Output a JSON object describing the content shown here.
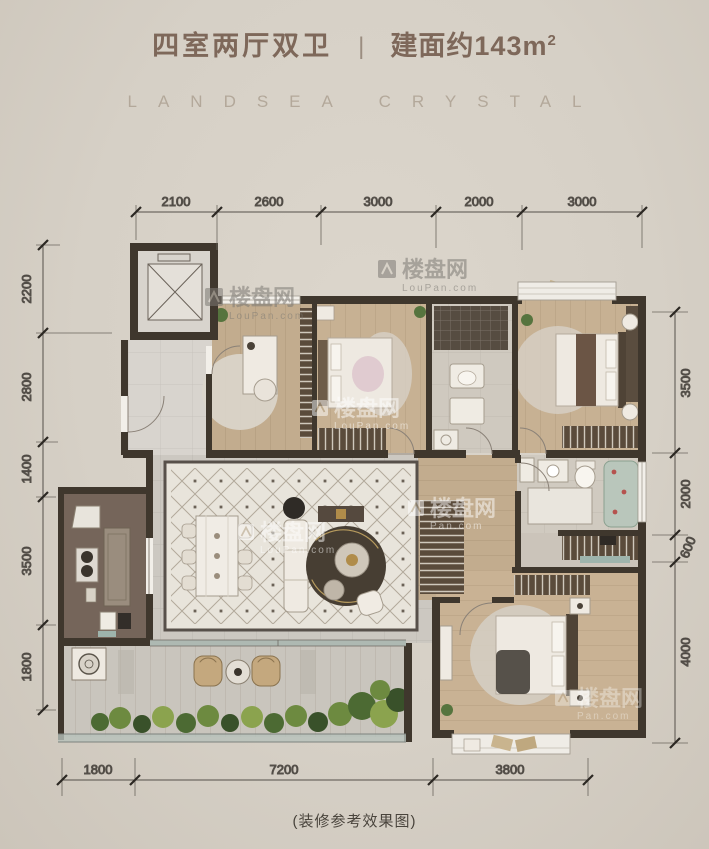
{
  "header": {
    "title": "四室两厅双卫",
    "separator": "|",
    "area_text": "建面约143m",
    "area_sup": "2",
    "brand": "LANDSEA CRYSTAL"
  },
  "dimensions": {
    "top": [
      "2100",
      "2600",
      "3000",
      "2000",
      "3000"
    ],
    "left": [
      "2200",
      "2800",
      "1400",
      "3500",
      "1800"
    ],
    "right": [
      "3500",
      "2000",
      "600",
      "4000"
    ],
    "bottom": [
      "1800",
      "7200",
      "3800"
    ]
  },
  "caption": "(装修参考效果图)",
  "watermark": {
    "brand": "楼盘网",
    "domain": "LouPan.com",
    "domain_short": "Pan.com"
  },
  "colors": {
    "title": "#7e685a",
    "brand_text": "#b3a89a",
    "wall": "#3f372d",
    "wood_floor": "#c3ad90",
    "dim_text": "#3a362f"
  }
}
